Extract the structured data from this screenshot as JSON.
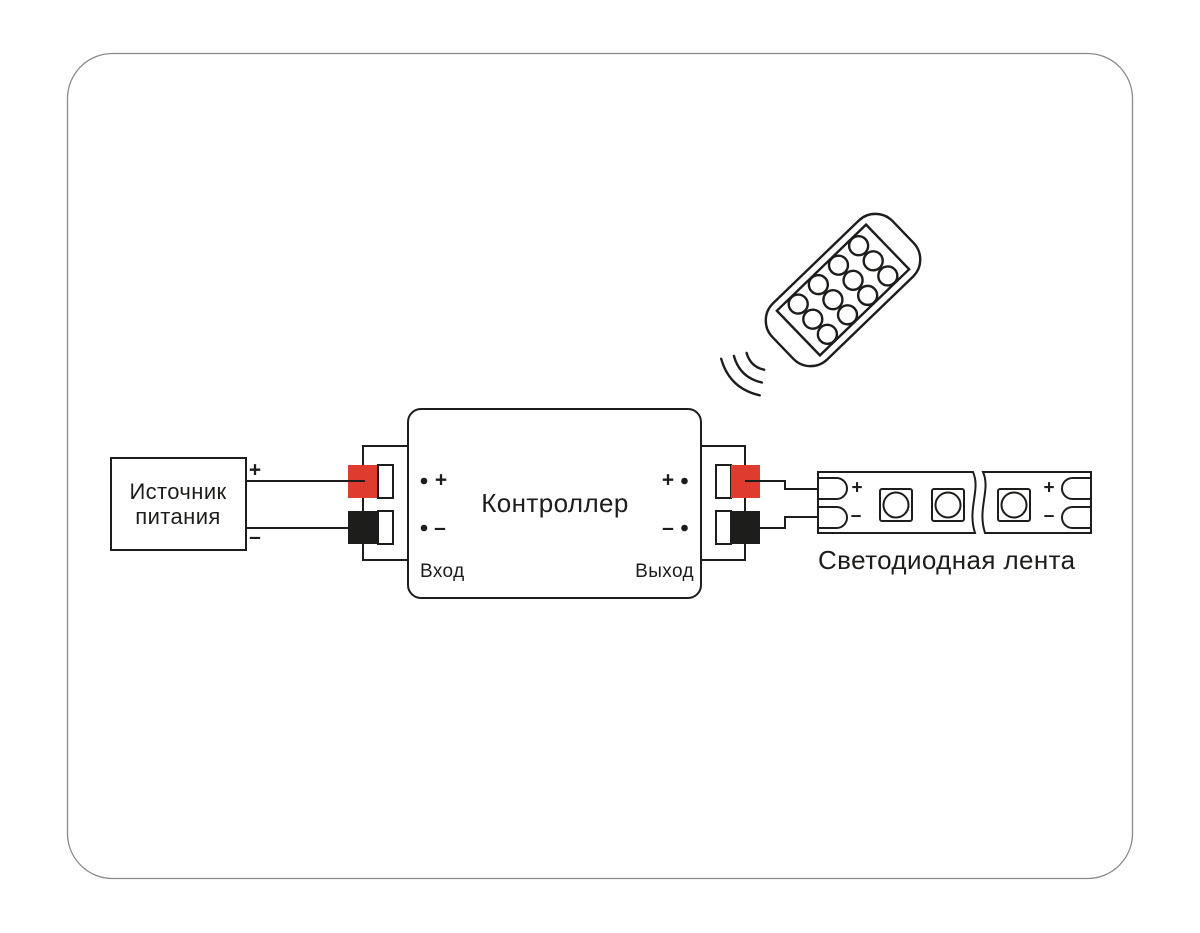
{
  "colors": {
    "red": "#df3b2e",
    "black": "#1d1d1b",
    "line": "#1d1d1b",
    "frame_gray": "#8a8a8a",
    "background": "#ffffff"
  },
  "power_supply": {
    "name_line1": "Источник",
    "name_line2": "питания",
    "plus": "+",
    "minus": "–"
  },
  "controller": {
    "title": "Контроллер",
    "input": "Вход",
    "output": "Выход",
    "plus": "+",
    "minus": "–"
  },
  "led_strip": {
    "caption": "Светодиодная лента",
    "plus": "+",
    "minus": "–"
  },
  "remote": {
    "icon": "remote-control-icon",
    "signal_icon": "wireless-signal-icon",
    "button_count": 12
  }
}
